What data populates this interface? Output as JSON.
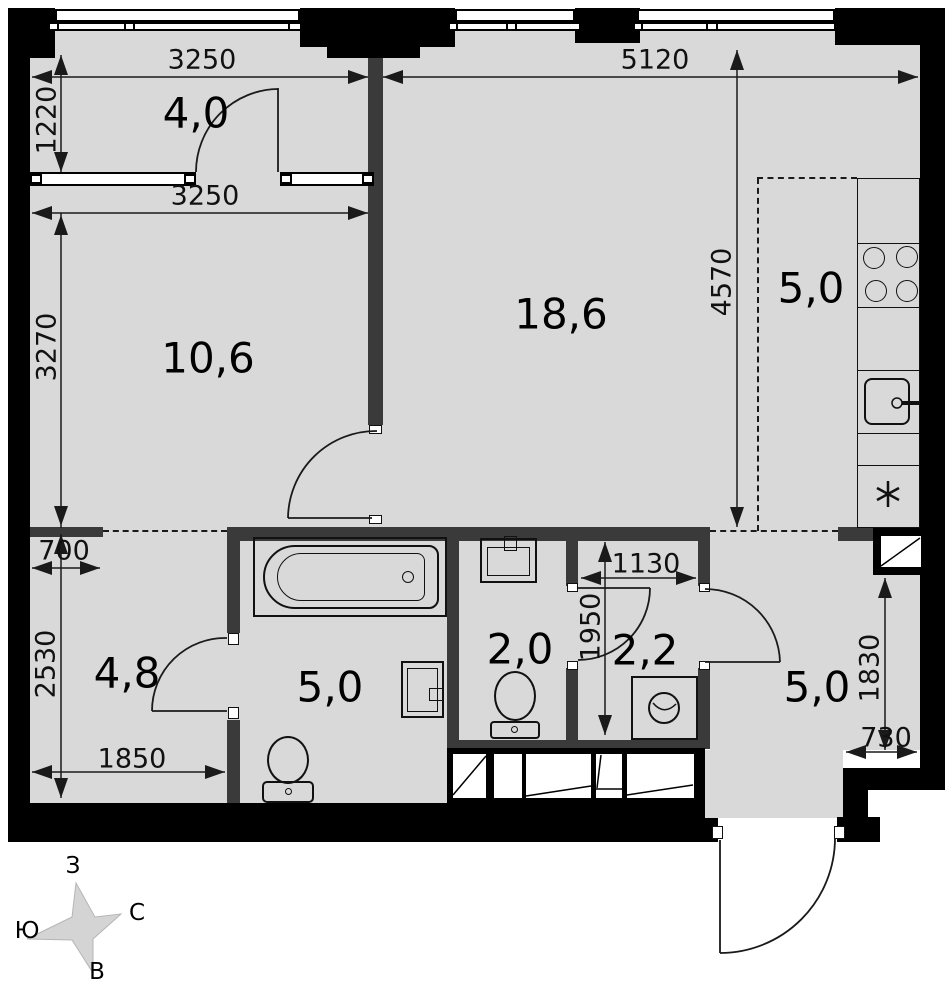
{
  "plan_title": "apartment-floor-plan",
  "rooms": {
    "loggia": "4,0",
    "bedroom": "10,6",
    "living": "18,6",
    "kitchen": "5,0",
    "hallway": "4,8",
    "bathroom": "5,0",
    "wc": "2,0",
    "closet": "2,2",
    "entry": "5,0"
  },
  "dims": {
    "loggia_width": "3250",
    "living_width": "5120",
    "loggia_depth": "1220",
    "bedroom_width": "3250",
    "bedroom_depth": "3270",
    "living_depth": "4570",
    "niche_width": "700",
    "hallway_depth": "2530",
    "hallway_width": "1850",
    "closet_width": "1130",
    "closet_depth": "1950",
    "entry_depth": "1830",
    "entry_width": "730"
  },
  "compass": {
    "west": "З",
    "north": "С",
    "south": "Ю",
    "east": "В"
  },
  "colors": {
    "floor": "#d9d9d9",
    "wall": "#000000",
    "partition": "#3a3a3a",
    "star": "#d4d4d4"
  },
  "icons": {
    "bathtub": "bathtub-icon",
    "toilet": "toilet-icon",
    "sink": "sink-icon",
    "washing_machine": "washing-machine-icon",
    "stove": "stove-4-burner-icon",
    "kitchen_sink": "kitchen-sink-icon",
    "vent_shaft": "ventilation-shaft-icon",
    "appliance_marker": "✳",
    "compass_star": "compass-star-icon"
  }
}
